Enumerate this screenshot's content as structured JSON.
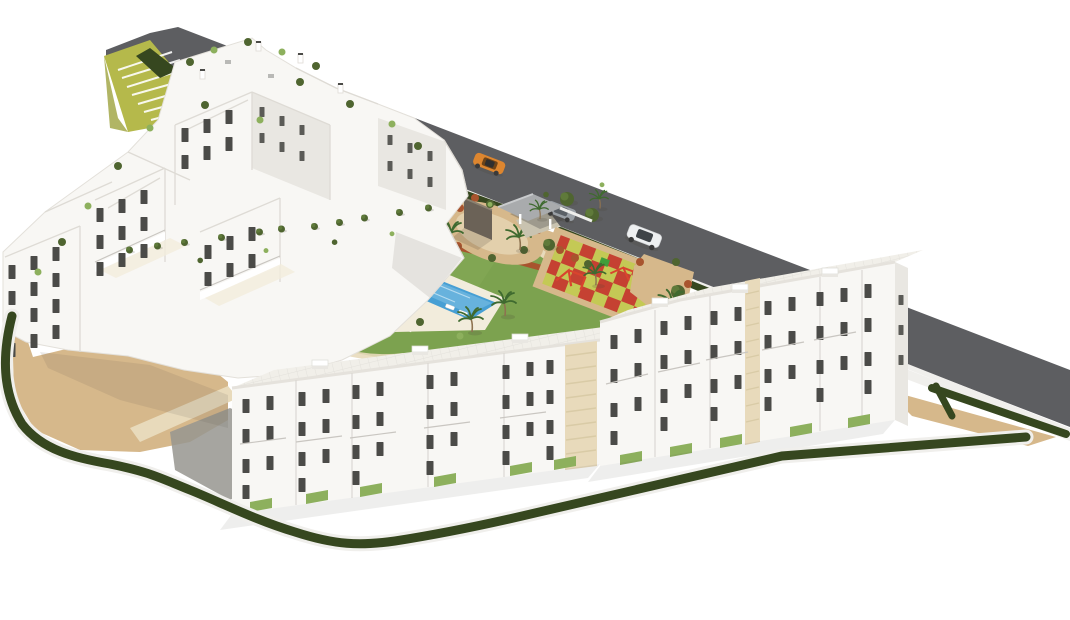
{
  "meta": {
    "type": "3d-architectural-render",
    "subject": "Aerial 3D render of a white residential apartment complex with central gardens, swimming pools, playground, amphitheater steps and an access road with cars",
    "vehicle_count": 3
  },
  "palette": {
    "background": "#ffffff",
    "road": "#5d5e61",
    "wall": "#f0efec",
    "hedge": "#42552a",
    "hedgedark": "#36471f",
    "lawn": "#7ca24f",
    "lawnlight": "#8db05d",
    "sand": "#d6b88b",
    "sandlight": "#e8dabb",
    "deck": "#f2ecdc",
    "brickpath": "#bf997f",
    "pool": "#479fd4",
    "poollight": "#8fc9e9",
    "white": "#f8f7f4",
    "shade": "#e9e7e2",
    "shade2": "#d9d6d1",
    "line": "#dedbd5",
    "window": "#4b4b48",
    "rail": "#c9c6c1",
    "tile": "#f1efe9",
    "gravel": "#45443e",
    "ramp": "#96958f",
    "stairgreen": "#b5b94b",
    "rust": "#a8542e",
    "olive": "#4f6530",
    "olivelight": "#62793c",
    "palmgreen": "#3f6a2f",
    "trunk": "#8d7250",
    "playred": "#c43b2d",
    "playyellow": "#c3ca52",
    "equipred": "#d9442e",
    "equipgreen": "#3f9e3a",
    "monument": "#6b6257",
    "canopy": "#a9abad",
    "carorange": "#dd862f",
    "carsilver": "#9aa0a6",
    "carwhite": "#eef0f1",
    "shadow": "#5b554a"
  },
  "scene": {
    "vehicles": [
      {
        "name": "orange-car"
      },
      {
        "name": "silver-car"
      },
      {
        "name": "white-suv"
      }
    ],
    "amenities": [
      "access-road",
      "amphitheater-stairs",
      "swimming-pool",
      "kids-pool",
      "sun-deck",
      "circular-plaza",
      "playground",
      "carport-entrance",
      "gardens",
      "sand-esplanade",
      "perimeter-hedge"
    ],
    "buildings": [
      "back-terraced-cluster",
      "left-apartment-block",
      "front-row-left",
      "front-row-right"
    ]
  }
}
